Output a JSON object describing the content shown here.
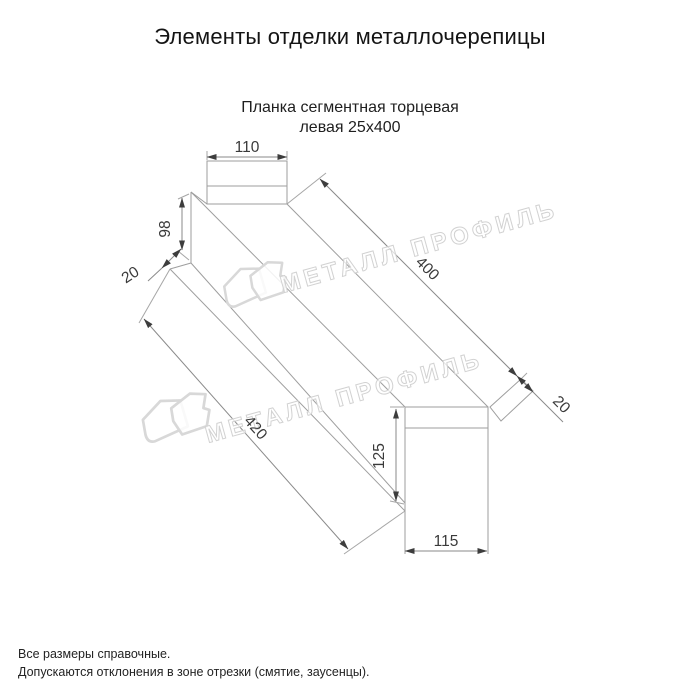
{
  "header": {
    "title": "Элементы отделки металлочерепицы"
  },
  "product": {
    "name_line1": "Планка сегментная торцевая",
    "name_line2": "левая 25х400"
  },
  "dims": {
    "top_width": "110",
    "side_height": "98",
    "left_fold": "20",
    "length_top": "400",
    "right_fold": "20",
    "length_bottom": "420",
    "end_height": "125",
    "end_width": "115"
  },
  "watermark": {
    "text": "МЕТАЛЛ ПРОФИЛЬ",
    "logo": "metall-profil-house-logo"
  },
  "notes": {
    "line1": "Все размеры справочные.",
    "line2": "Допускаются отклонения в зоне отрезки (смятие, заусенцы)."
  },
  "colors": {
    "line": "#9e9e9e",
    "dimension_text": "#3a3a3a",
    "watermark": "#d2d2d2",
    "background": "#ffffff"
  }
}
